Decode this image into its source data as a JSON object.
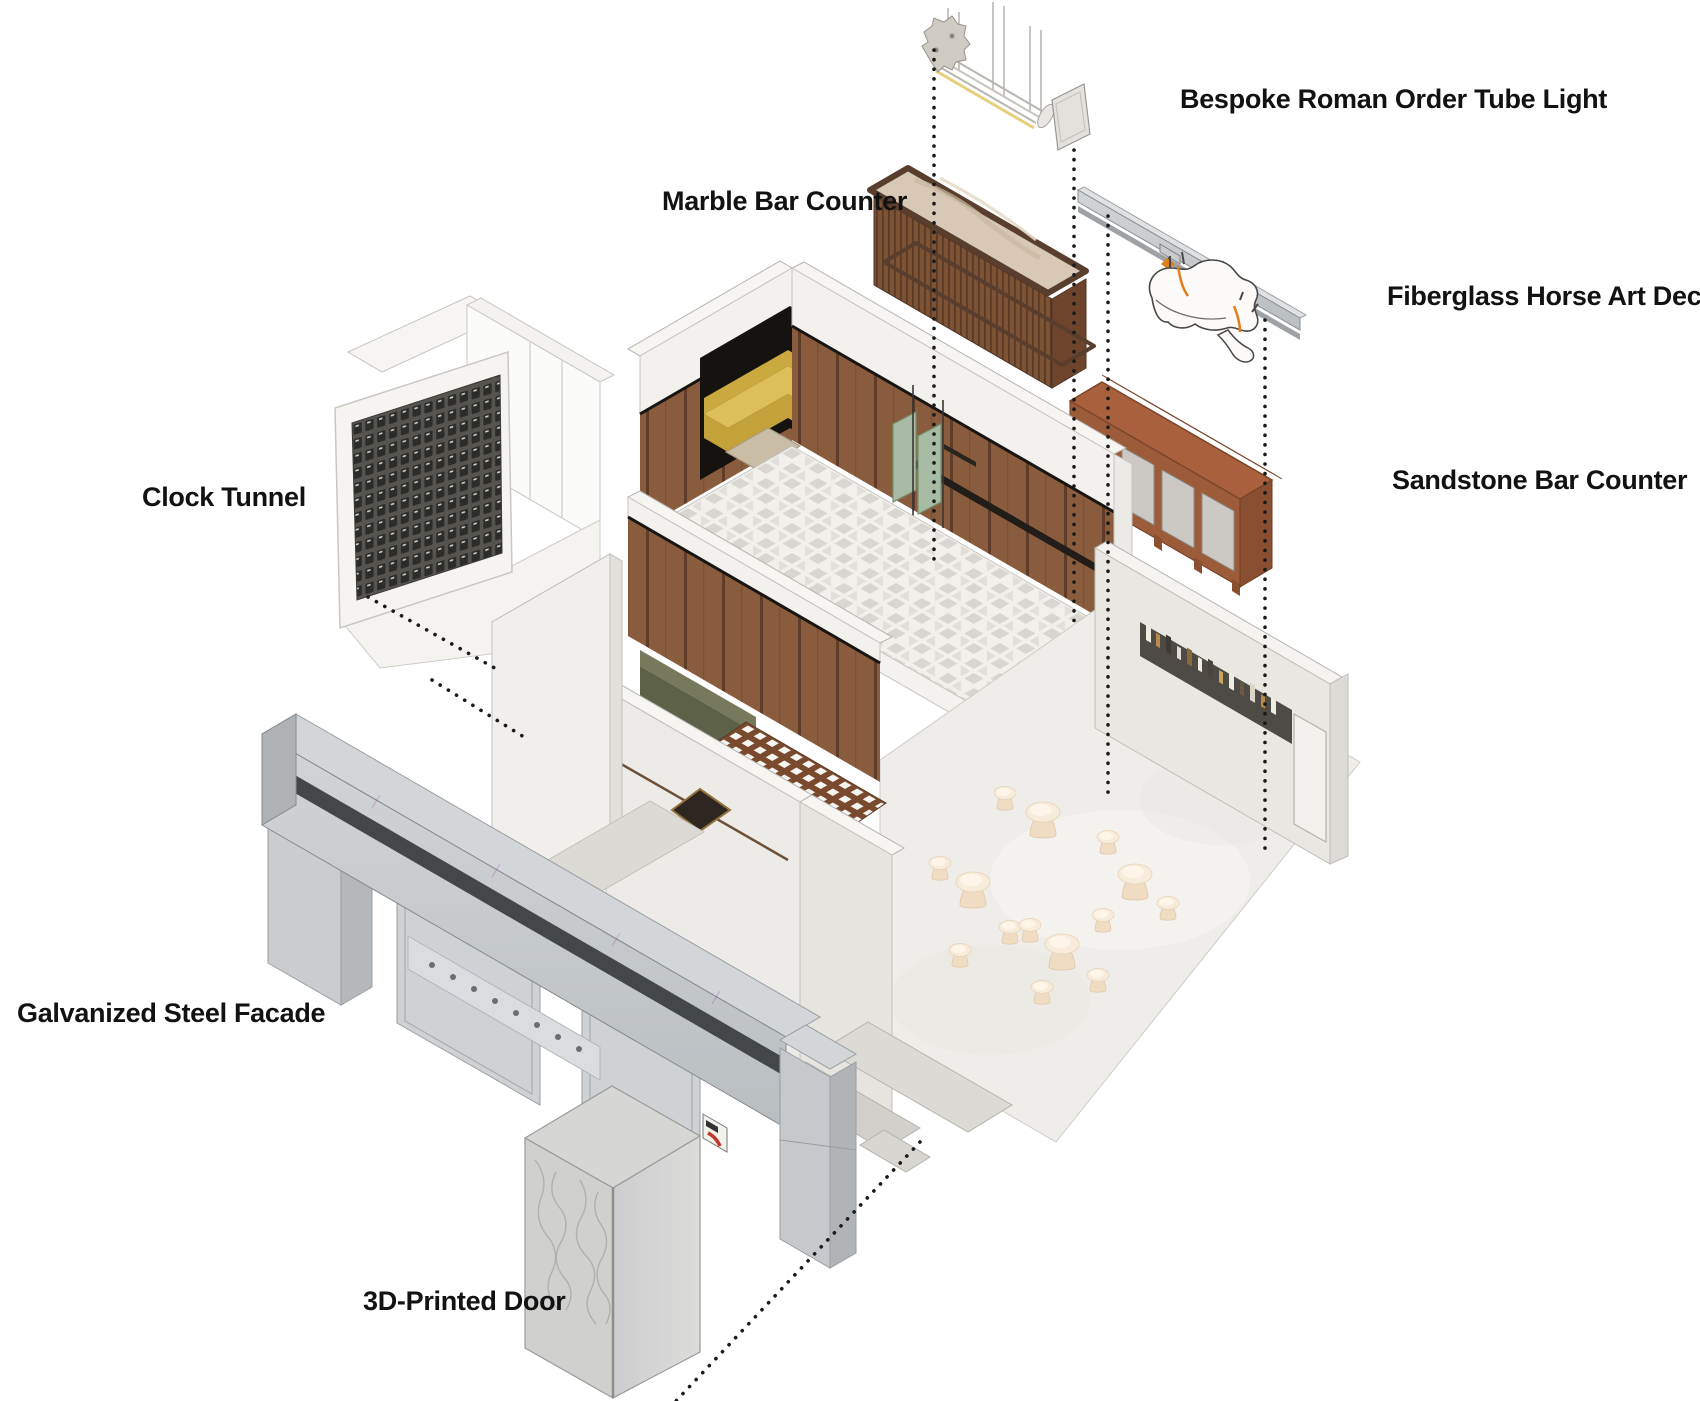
{
  "diagram": {
    "type": "exploded-axonometric-interior",
    "labels": {
      "tube_light": "Bespoke Roman Order Tube Light",
      "marble_counter": "Marble Bar Counter",
      "horse_decor": "Fiberglass Horse Art Decor",
      "sandstone_counter": "Sandstone Bar Counter",
      "clock_tunnel": "Clock Tunnel",
      "steel_facade": "Galvanized Steel Facade",
      "printed_door": "3D-Printed Door"
    },
    "colors": {
      "background": "#ffffff",
      "label_text": "#121212",
      "dotted_guide": "#1a1a1a",
      "wood_panel": "#8a5c3e",
      "marble_top": "#d7c9b6",
      "counter_frame_brown": "#5a3e2d",
      "sandstone": "#a8613c",
      "booth_yellow": "#dcbf58",
      "sage_door": "#a8bba5",
      "bench_olive": "#6b7052",
      "lattice_brown": "#7a4a2e",
      "galvanized_steel": "#c6cbce",
      "plaster_white": "#efede9",
      "stool_cream": "#f3e2cb",
      "horse_white": "#fbfaf8",
      "accent_orange": "#e07f1e",
      "logo_red": "#c0392b"
    }
  }
}
